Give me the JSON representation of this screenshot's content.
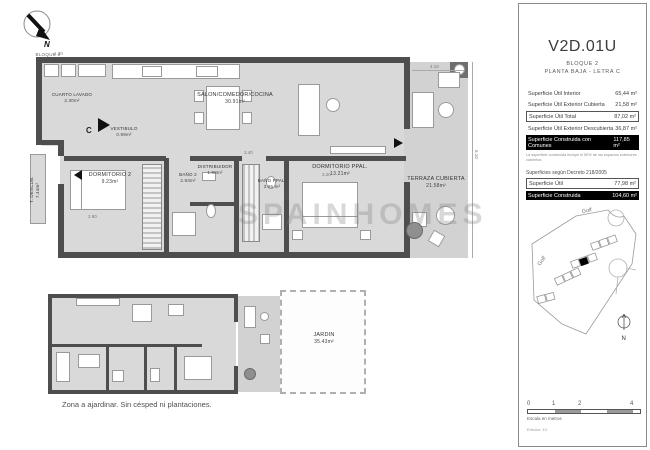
{
  "meta": {
    "watermark": "SPAINHOMES"
  },
  "north_block": {
    "label": "BLOQUE 2"
  },
  "main_plan": {
    "rooms": [
      {
        "name": "CUARTO LAVADO",
        "area": "2.30m²"
      },
      {
        "name": "VESTIBULO",
        "area": "0.99m²"
      },
      {
        "name": "SALON/COMEDOR/COCINA",
        "area": "30.91m²"
      },
      {
        "name": "DISTRIBUIDOR",
        "area": "1.98m²"
      },
      {
        "name": "DORMITORIO 2",
        "area": "9.23m²"
      },
      {
        "name": "BAÑO 2",
        "area": "2.93m²"
      },
      {
        "name": "BAÑO PPAL.",
        "area": "3.86 m²"
      },
      {
        "name": "DORMITORIO PPAL.",
        "area": "13.21m²"
      },
      {
        "name": "TERRAZA CUBIERTA",
        "area": "21.58m²"
      },
      {
        "name": "T. DESCUB.",
        "area": "7.44m²"
      }
    ],
    "entrance_label": "C",
    "dimensions": {
      "d1": "1.30",
      "d2": "2.80",
      "d3": "3.20",
      "d4": "3.40",
      "d5": "4.10",
      "d6": "6.10"
    }
  },
  "lower_plan": {
    "garden": {
      "name": "JARDIN",
      "area": "35.43m²"
    },
    "caption": "Zona a ajardinar. Sin césped ni plantaciones."
  },
  "sidebar": {
    "unit": "V2D.01U",
    "block": "BLOQUE 2",
    "floor": "PLANTA BAJA - LETRA C",
    "areas": [
      {
        "label": "Superficie Útil Interior",
        "value": "65,44 m²"
      },
      {
        "label": "Superficie Útil Exterior Cubierta",
        "value": "21,58 m²"
      },
      {
        "label": "Superficie Útil Total",
        "value": "87,02 m²"
      },
      {
        "label": "Superficie Útil Exterior Descubierta",
        "value": "36,87 m²"
      },
      {
        "label": "Superficie Construida con Comunes",
        "value": "117,85 m²"
      }
    ],
    "note": "La superficie construida incluye el 50% de los espacios exteriores cubiertos",
    "decree_heading": "Superficies según Decreto 218/2005",
    "decree_areas": [
      {
        "label": "Superficie Útil",
        "value": "77,98 m²"
      },
      {
        "label": "Superficie Construida",
        "value": "104,60 m²"
      }
    ],
    "map": {
      "golf_top": "Golf",
      "golf_left": "Golf",
      "compass": "N"
    },
    "scale": {
      "t0": "0",
      "t1": "1",
      "t2": "2",
      "t4": "4",
      "caption": "Escala en metros",
      "edition": "Edición: 10"
    }
  }
}
